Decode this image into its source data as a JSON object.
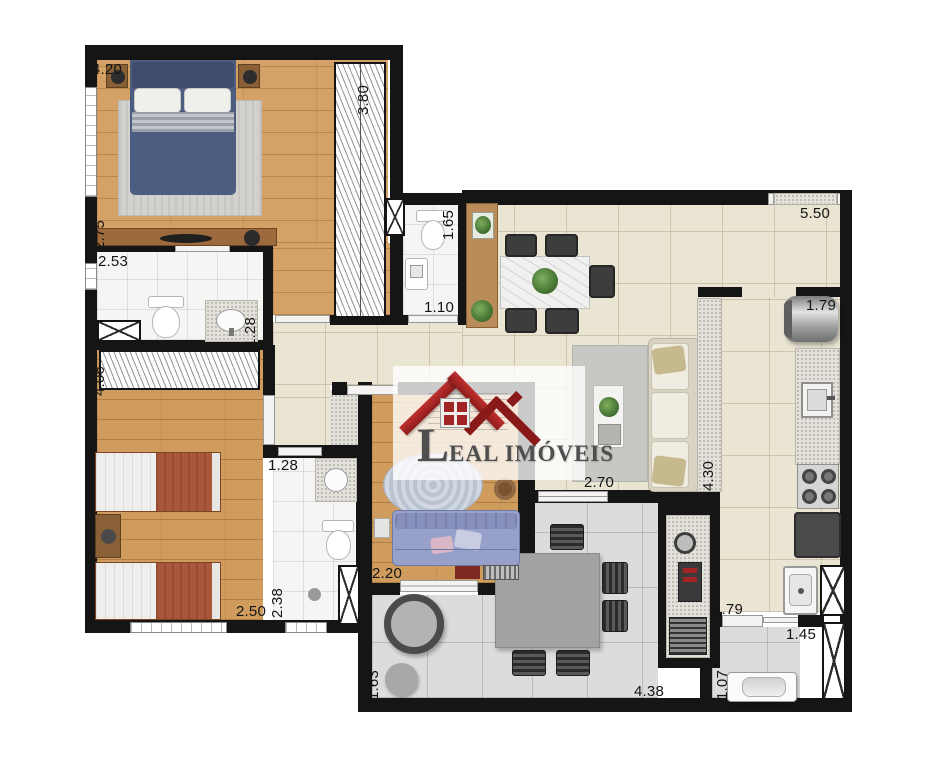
{
  "logo": {
    "initial": "L",
    "rest": "EAL IMÓVEIS",
    "full": "LEAL IMÓVEIS"
  },
  "dimensions": [
    {
      "id": "suite-width",
      "v": "4.20"
    },
    {
      "id": "suite-wardrobe-depth",
      "v": "3.80"
    },
    {
      "id": "suite-side-depth",
      "v": "2.75"
    },
    {
      "id": "suite-bath-width",
      "v": "2.53"
    },
    {
      "id": "lavabo-depth",
      "v": "1.65"
    },
    {
      "id": "lavabo-width",
      "v": "1.10"
    },
    {
      "id": "living-width",
      "v": "5.50"
    },
    {
      "id": "kitchen-pass-width",
      "v": "1.79"
    },
    {
      "id": "suite-bath-depth",
      "v": "1.28"
    },
    {
      "id": "bedroom2-wardrobe-width",
      "v": "4.06"
    },
    {
      "id": "bedroom2-width",
      "v": "2.50"
    },
    {
      "id": "bath2-width",
      "v": "1.28"
    },
    {
      "id": "bath2-depth",
      "v": "2.38"
    },
    {
      "id": "den-width",
      "v": "2.20"
    },
    {
      "id": "living-opening-width",
      "v": "2.70"
    },
    {
      "id": "counter-length",
      "v": "4.30"
    },
    {
      "id": "balcony-depth",
      "v": "1.63"
    },
    {
      "id": "balcony-width",
      "v": "4.38"
    },
    {
      "id": "laundry-pass-width",
      "v": "1.79"
    },
    {
      "id": "laundry-width",
      "v": "1.45"
    },
    {
      "id": "laundry-depth",
      "v": "1.07"
    }
  ],
  "colors": {
    "wall": "#151515",
    "wood": "#d4a266",
    "tile_beige": "#eae4d3",
    "tile_gray": "#dcdcda",
    "bath_tile": "#f5f5f4",
    "accent_red": "#a32424",
    "bed_blue": "#4d5d82",
    "bed_terracotta": "#a9573a",
    "sofa_blue": "#97a0c8",
    "sofa_beige": "#e8e3d5",
    "logo_text": "#4f4f4f"
  }
}
